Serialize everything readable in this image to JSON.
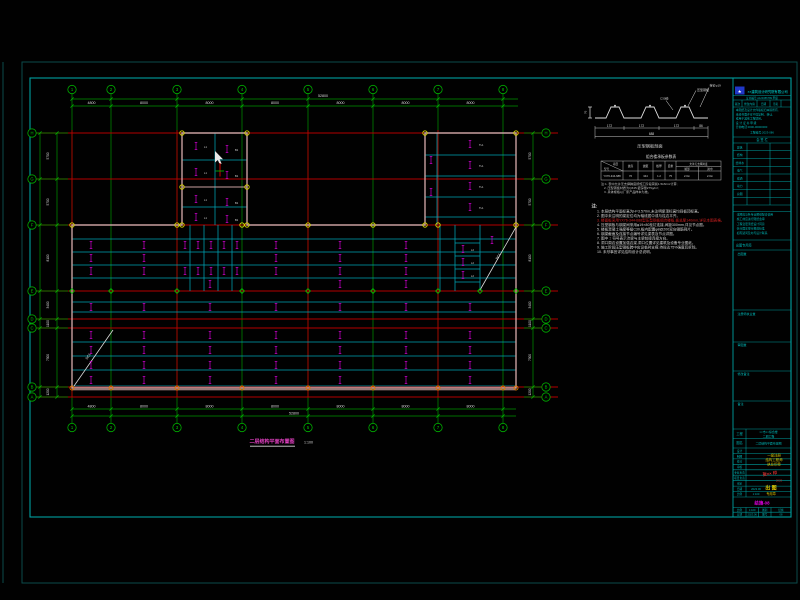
{
  "footer": {
    "title": "二层结构平面布置图",
    "scale": "1:100"
  },
  "grid": {
    "cols": [
      {
        "label": "1",
        "x": 72
      },
      {
        "label": "2",
        "x": 111
      },
      {
        "label": "3",
        "x": 177
      },
      {
        "label": "4",
        "x": 242
      },
      {
        "label": "5",
        "x": 308
      },
      {
        "label": "6",
        "x": 373
      },
      {
        "label": "7",
        "x": 438
      },
      {
        "label": "8",
        "x": 503
      }
    ],
    "rows": [
      {
        "label": "H",
        "y": 133
      },
      {
        "label": "G",
        "y": 179
      },
      {
        "label": "F",
        "y": 225
      },
      {
        "label": "E",
        "y": 291
      },
      {
        "label": "D",
        "y": 319
      },
      {
        "label": "C",
        "y": 328
      },
      {
        "label": "B",
        "y": 387
      },
      {
        "label": "A",
        "y": 397
      }
    ],
    "top_dims": [
      "4800",
      "8000",
      "8000",
      "8000",
      "8000",
      "8000",
      "8000"
    ],
    "top_total": "52800",
    "bottom_dims": [
      "4800",
      "8000",
      "8000",
      "8000",
      "8000",
      "8000",
      "8000"
    ],
    "bottom_total": "52800",
    "left_dims": [
      "5700",
      "5700",
      "8100",
      "3400",
      "1100",
      "7300",
      "1200"
    ],
    "right_dims": [
      "5700",
      "5700",
      "8100",
      "3400",
      "1100",
      "7300",
      "1200"
    ]
  },
  "plan": {
    "red_cols": [
      72,
      177,
      308,
      438
    ],
    "tick_rows": [
      {
        "y": 245,
        "xs": [
          91,
          144,
          185,
          198,
          211,
          224,
          237,
          276,
          340,
          406
        ]
      },
      {
        "y": 258,
        "xs": [
          91,
          144,
          276,
          340,
          406
        ]
      },
      {
        "y": 271,
        "xs": [
          91,
          144,
          185,
          198,
          211,
          224,
          237,
          276,
          340,
          406
        ]
      },
      {
        "y": 284,
        "xs": [
          210,
          340,
          406
        ]
      },
      {
        "y": 307,
        "xs": [
          91,
          144,
          210,
          276,
          340,
          406,
          470
        ]
      },
      {
        "y": 335,
        "xs": [
          91,
          144,
          210,
          276,
          340,
          406,
          470
        ]
      },
      {
        "y": 350,
        "xs": [
          91,
          144,
          210,
          276,
          340,
          406,
          470
        ]
      },
      {
        "y": 365,
        "xs": [
          91,
          144,
          210,
          276,
          340,
          406,
          470
        ]
      },
      {
        "y": 380,
        "xs": [
          91,
          144,
          210,
          276,
          340,
          406,
          470
        ]
      }
    ],
    "ticks_extra": [
      [
        196,
        146
      ],
      [
        227,
        149
      ],
      [
        196,
        172
      ],
      [
        227,
        175
      ],
      [
        196,
        199
      ],
      [
        227,
        202
      ],
      [
        196,
        217
      ],
      [
        227,
        219
      ],
      [
        470,
        144
      ],
      [
        470,
        165
      ],
      [
        470,
        186
      ],
      [
        470,
        207
      ],
      [
        431,
        160
      ],
      [
        431,
        192
      ],
      [
        463,
        249
      ],
      [
        463,
        262
      ],
      [
        463,
        275
      ],
      [
        492,
        240
      ]
    ],
    "cell_labels": [
      {
        "t": "L1",
        "x": 204,
        "y": 148
      },
      {
        "t": "B1",
        "x": 235,
        "y": 151
      },
      {
        "t": "L1",
        "x": 204,
        "y": 174
      },
      {
        "t": "B1",
        "x": 235,
        "y": 177
      },
      {
        "t": "L1",
        "x": 204,
        "y": 201
      },
      {
        "t": "B1",
        "x": 235,
        "y": 204
      },
      {
        "t": "L1",
        "x": 204,
        "y": 219
      },
      {
        "t": "B1",
        "x": 235,
        "y": 221
      },
      {
        "t": "TL1",
        "x": 479,
        "y": 146
      },
      {
        "t": "TL1",
        "x": 479,
        "y": 167
      },
      {
        "t": "TL1",
        "x": 479,
        "y": 188
      },
      {
        "t": "TL1",
        "x": 479,
        "y": 209
      },
      {
        "t": "L2",
        "x": 471,
        "y": 251
      },
      {
        "t": "L2",
        "x": 471,
        "y": 264
      },
      {
        "t": "L2",
        "x": 471,
        "y": 277
      }
    ],
    "brace_labels": [
      {
        "t": "SC1",
        "x": 89,
        "y": 357,
        "r": -55
      },
      {
        "t": "SC1",
        "x": 499,
        "y": 257,
        "r": -60
      }
    ],
    "nodes_yellow": [
      [
        182,
        133
      ],
      [
        247,
        133
      ],
      [
        182,
        187
      ],
      [
        247,
        187
      ],
      [
        182,
        225
      ],
      [
        247,
        225
      ],
      [
        425,
        133
      ],
      [
        516,
        133
      ],
      [
        425,
        225
      ],
      [
        516,
        225
      ],
      [
        72,
        225
      ],
      [
        177,
        225
      ],
      [
        242,
        225
      ],
      [
        308,
        225
      ],
      [
        373,
        225
      ],
      [
        438,
        225
      ]
    ],
    "nodes_orange": [
      [
        72,
        388
      ],
      [
        111,
        388
      ],
      [
        177,
        388
      ],
      [
        242,
        388
      ],
      [
        308,
        388
      ],
      [
        373,
        388
      ],
      [
        438,
        388
      ],
      [
        503,
        388
      ],
      [
        516,
        388
      ]
    ],
    "nodes_diamond": [
      [
        72,
        291
      ],
      [
        111,
        291
      ],
      [
        177,
        291
      ],
      [
        242,
        291
      ],
      [
        308,
        291
      ],
      [
        373,
        291
      ],
      [
        438,
        291
      ],
      [
        480,
        291
      ],
      [
        516,
        291
      ]
    ]
  },
  "detail": {
    "title": "压型钢板剖面",
    "callouts": [
      "压型钢板",
      "栓钉φ19",
      "C30砼"
    ],
    "dims": [
      "172",
      "172",
      "172",
      "86"
    ],
    "total": "688",
    "height": "76"
  },
  "table": {
    "title": "组合楼承板参数表",
    "corner_top": "项目",
    "corner_bottom": "型号",
    "headers": [
      "波高",
      "波距",
      "板厚",
      "自重",
      "允许无支撑跨度"
    ],
    "sub_headers": [
      "端部",
      "跨中"
    ],
    "row": [
      "YX76-344-688",
      "76",
      "344",
      "1.2",
      "75",
      "2.0m",
      "2.0m"
    ],
    "footnotes": [
      "注:1. 表中允许无支撑跨度按施工阶段荷载1.5kN/m²计算;",
      "2. 压型钢板材质为Q345,镀锌量275g/m²;",
      "3. 具体规格以厂家产品样本为准。"
    ]
  },
  "notes": {
    "header": "注:",
    "lines": [
      "1. 本层结构平面标高为H=3.570m,未注明梁顶标高均同板顶标高。",
      "2. 图中未注明的梁定位均为轴线居中或与柱边平齐。",
      "3. 楼面板采用YX76-344-688型压型钢板组合楼板,板总厚140mm,详见本图表格。",
      "4. 压型钢板与钢梁间采用φ19×80栓钉连接,间距300mm,详见节点图。",
      "5. 楼板混凝土强度等级C30,板内配置φ8@200双向钢筋网片。",
      "6. 钢梁截面及连接节点编号详见梁表及节点详图。",
      "7. 图中 ⌶ 符号表示次梁与主梁铰接连接方向。",
      "8. 洞口周边设置加强边梁,洞口位置详见建筑及设备专业图纸。",
      "9. 施工阶段压型钢板跨中应设临时支撑,待砼达75%强度后拆除。",
      "10. 未尽事宜详见结构设计总说明。"
    ]
  },
  "tb": {
    "logo_glyph": "★",
    "company": "××建筑设计研究院有限公司",
    "cert": "证书编号:A123456789  甲级",
    "rev_headers": [
      "版次",
      "修改内容",
      "日期",
      "签名"
    ],
    "copyright": [
      "本图纸及设计文件版权归本院所有,",
      "未经书面许可不得复制、转让,",
      "或用于其他工程项目。",
      "设 计 证 书  甲 级",
      "咨询电话:0000-00000000"
    ],
    "proj_no": "工程编号:2023-086",
    "huiqian": "会  签  栏",
    "sign_rows": [
      "建筑",
      "结构",
      "给排水",
      "电气",
      "暖通",
      "动力",
      "总图"
    ],
    "bullets": [
      "·本图应与各专业图纸配合使用",
      "·施工前应进行图纸会审",
      "·工程变更须经设计同意",
      "·执行国家现行规范标准",
      "·如有疑问及时与设计联系"
    ],
    "chutu": "出图专用章",
    "box_labels": [
      "出图章",
      "注册师执业章",
      "审图章",
      "修改备注",
      "备注"
    ],
    "proj_label": "工程",
    "proj_value1": "××市××综合楼",
    "proj_value2": "二期工程",
    "name_label": "图名",
    "name_value": "二层结构平面布置图",
    "row_labels": [
      "设计",
      "制图",
      "校对",
      "审核",
      "专业负责",
      "项目负责",
      "审定",
      "日期",
      "比例"
    ],
    "row_values": [
      "",
      "",
      "",
      "",
      "",
      "",
      "",
      "2023.06",
      "1:100"
    ],
    "stamp_yellow": [
      "一级注册",
      "结构工程师",
      "执业印章"
    ],
    "stamp_red": "张×× 印",
    "stamp_red2": "2023",
    "stamp_big": "出 图",
    "stamp_big2": "专用章",
    "drawing_no": "结施-08",
    "mini": [
      "比例",
      "1:100",
      "图别",
      "结施",
      "日期",
      "2023.06",
      "图号",
      "08"
    ]
  }
}
